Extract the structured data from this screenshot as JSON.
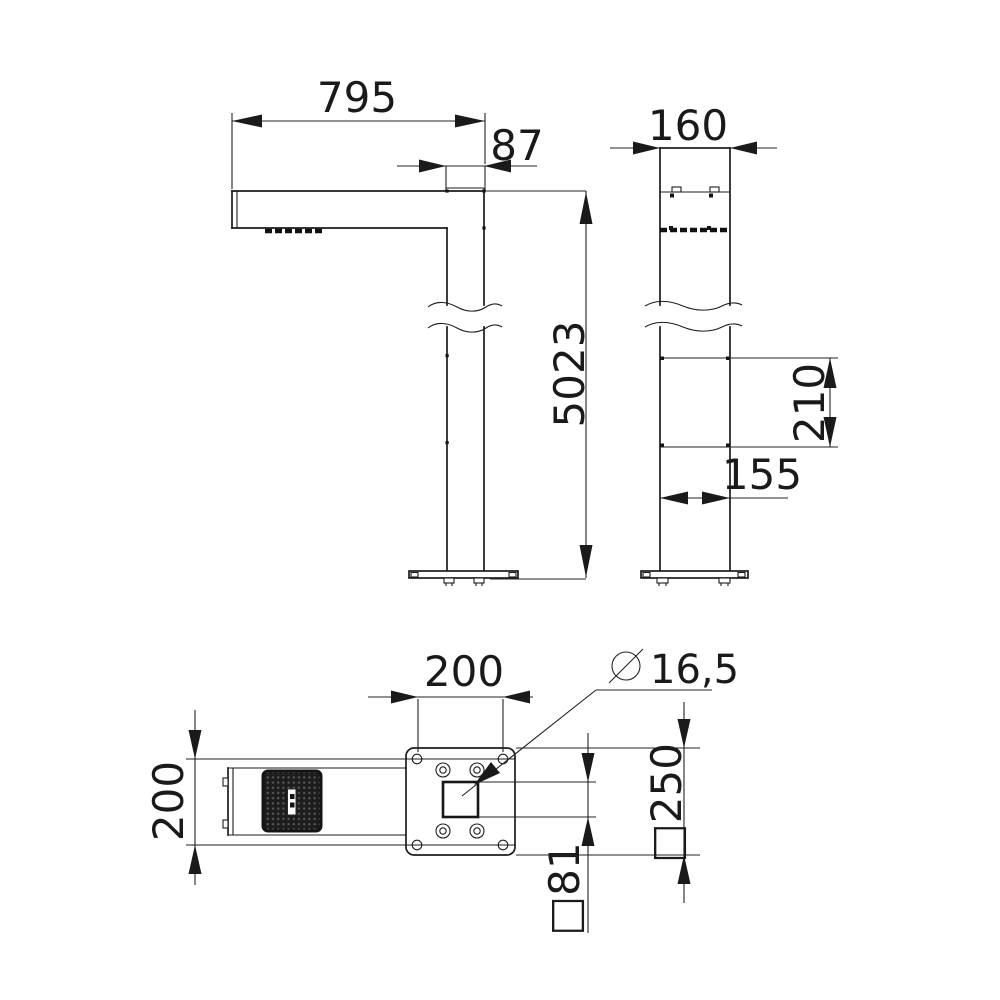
{
  "drawing": {
    "kind": "technical-drawing",
    "background": "#ffffff",
    "line_color": "#1c1c1c"
  },
  "views": {
    "side": {
      "arm_length": "795",
      "arm_end_depth": "87",
      "total_height": "5023"
    },
    "front": {
      "pole_width": "160",
      "panel_height": "210",
      "lower_width": "155"
    },
    "plan": {
      "bolt_spacing": "200",
      "arm_width": "200",
      "hole_diameter": "16,5",
      "base_plate_label": "□250",
      "pole_section_label": "□81"
    }
  }
}
